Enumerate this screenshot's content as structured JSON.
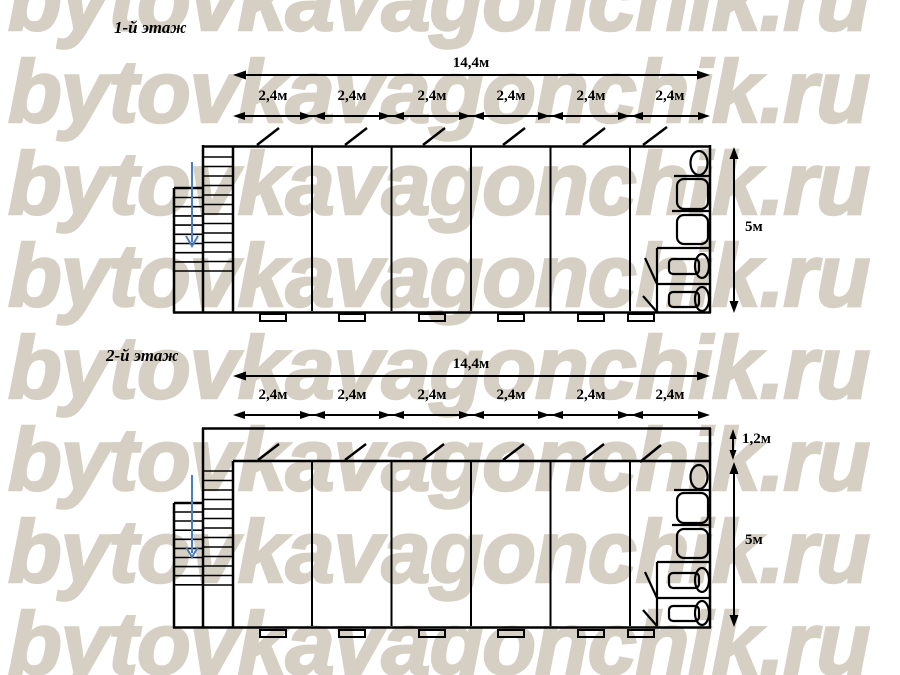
{
  "watermark": {
    "text": "bytovkavagonchik.ru",
    "color": "#d6cfc3"
  },
  "colors": {
    "background": "#ffffff",
    "line": "#000000",
    "stairs_arrow": "#4a7ebc"
  },
  "floors": [
    {
      "title": "1-й этаж",
      "total_width": "14,4м",
      "module_width": "2,4м",
      "height": "5м",
      "module_count": 6
    },
    {
      "title": "2-й этаж",
      "total_width": "14,4м",
      "module_width": "2,4м",
      "height": "5м",
      "corridor_width": "1,2м",
      "module_count": 6
    }
  ]
}
